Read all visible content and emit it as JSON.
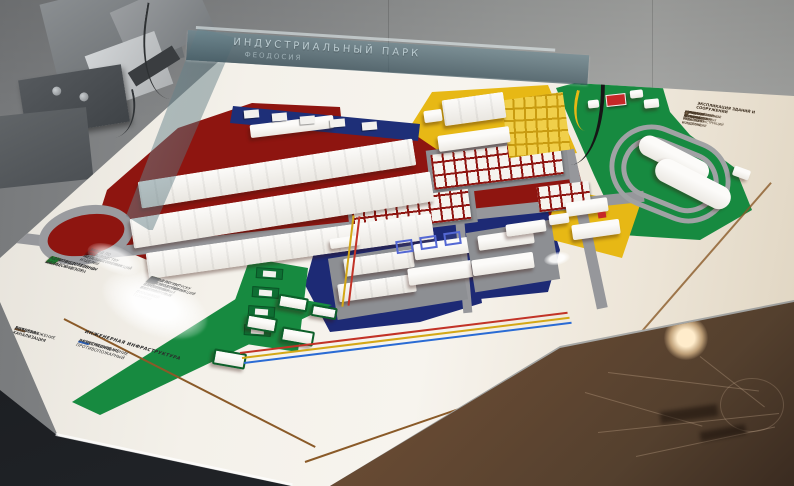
{
  "glass": {
    "title_line1": "ИНДУСТРИАЛЬНЫЙ ПАРК",
    "title_line2": "ФЕОДОСИЯ"
  },
  "legend": {
    "zones": [
      {
        "color": "#cf1c1c",
        "label": "ПРОИЗВОДСТВЕННАЯ ЗОНА"
      },
      {
        "color": "#e8c11c",
        "label": "ПРОИЗВОДСТВЕННО-СКЛАДСКАЯ ЗОНА"
      },
      {
        "color": "#1c7a30",
        "label": "АДМИНИСТРАТИВНО-ДЕЛОВОЙ ЦЕНТР"
      }
    ],
    "factories_mid": [
      {
        "color": "#d42020",
        "label": "ЗАВОД ПО ПРОИЗВОДСТВУ МЕТАЛЛОКОНСТРУКЦИЙ"
      },
      {
        "color": "#7a1010",
        "label": "ЗАВОД ПО ПРОИЗВОДСТВУ ЖЕЛЕЗОБЕТОННЫХ ИЗДЕЛИЙ"
      }
    ],
    "factories_right": [
      {
        "color": "#1c7a30",
        "label": "ЗАВОД ПО ВЫПУСКУ МЕТАЛЛОКОНСТРУКЦИЙ НА ОСНОВЕ АЛЮМИНИЕВЫХ ПРОФИЛЕЙ"
      },
      {
        "color": "#e8c11c",
        "label": "ЗАВОД ЖЕЛЕЗОБЕТОННЫХ И БЕТОННЫХ ИЗДЕЛИЙ"
      },
      {
        "color": "#55585c",
        "label": "ЗАВОД ПО ПРОИЗВОДСТВУ СТРОИТЕЛЬНЫХ МАТЕРИАЛОВ И ДОРОЖНОЙ ТЕХНИКИ"
      },
      {
        "color": "#33363a",
        "label": "КОМБИНАТ ПО ПРОИЗВОДСТВУ ЦЕМЕНТНЫХ СМЕСЕЙ"
      }
    ],
    "networks_left": [
      {
        "color": "#2a6bd4",
        "label": "ВОДОСНАБЖЕНИЕ"
      },
      {
        "color": "#3a3a3a",
        "label": "ЛИВНЕВАЯ КАНАЛИЗАЦИЯ"
      },
      {
        "color": "#6a4a2a",
        "label": "БЫТОВАЯ КАНАЛИЗАЦИЯ"
      }
    ],
    "infrastructure": {
      "header": "ИНЖЕНЕРНАЯ ИНФРАСТРУКТУРА",
      "items": [
        {
          "color": "#d42020",
          "label": "ЭЛЕКТРОСНАБЖЕНИЕ"
        },
        {
          "color": "#e8c11c",
          "label": "ГАЗОСНАБЖЕНИЕ"
        },
        {
          "color": "#2a6bd4",
          "label": "ВОДОПРОВОД ПРОТИВОПОЖАРНЫЙ"
        }
      ]
    }
  },
  "explication": {
    "header": "ЭКСПЛИКАЦИЯ ЗДАНИЙ И СООРУЖЕНИЙ",
    "items": [
      "АДМИНИСТРАТИВНО-ДЕЛОВОЙ ЦЕНТР",
      "ПРОИЗВОДСТВЕННЫЙ КОРПУС № 1",
      "ЗАВОД ПО ПРОИЗВОДСТВУ МЕТАЛЛОКОНСТРУКЦИЙ И ИЗДЕЛИЙ",
      "ЗАВОД ЖЕЛЕЗОБЕТОННЫХ ИЗДЕЛИЙ И КОНСТРУКЦИЙ",
      "ЛОГИСТИЧЕСКИЙ КОМПЛЕКС",
      "СКЛАДСКОЙ КОМПЛЕКС",
      "ОЧИСТНЫЕ СООРУЖЕНИЯ",
      "КОТЕЛЬНАЯ",
      "СТОЯНКА ГРУЗОВОГО ТРАНСПОРТА"
    ]
  },
  "colors": {
    "zone_production_red": "#8e1510",
    "zone_storage_yellow": "#e7b815",
    "zone_logistics_blue": "#1d2a75",
    "zone_admin_green": "#178a40",
    "board_white": "#f4f1ea",
    "table_brown": "#6b4c34",
    "utility_red": "#c23327",
    "utility_yellow": "#d4a817",
    "utility_blue": "#2a6bd4",
    "boundary_brown": "#8a5a28"
  }
}
